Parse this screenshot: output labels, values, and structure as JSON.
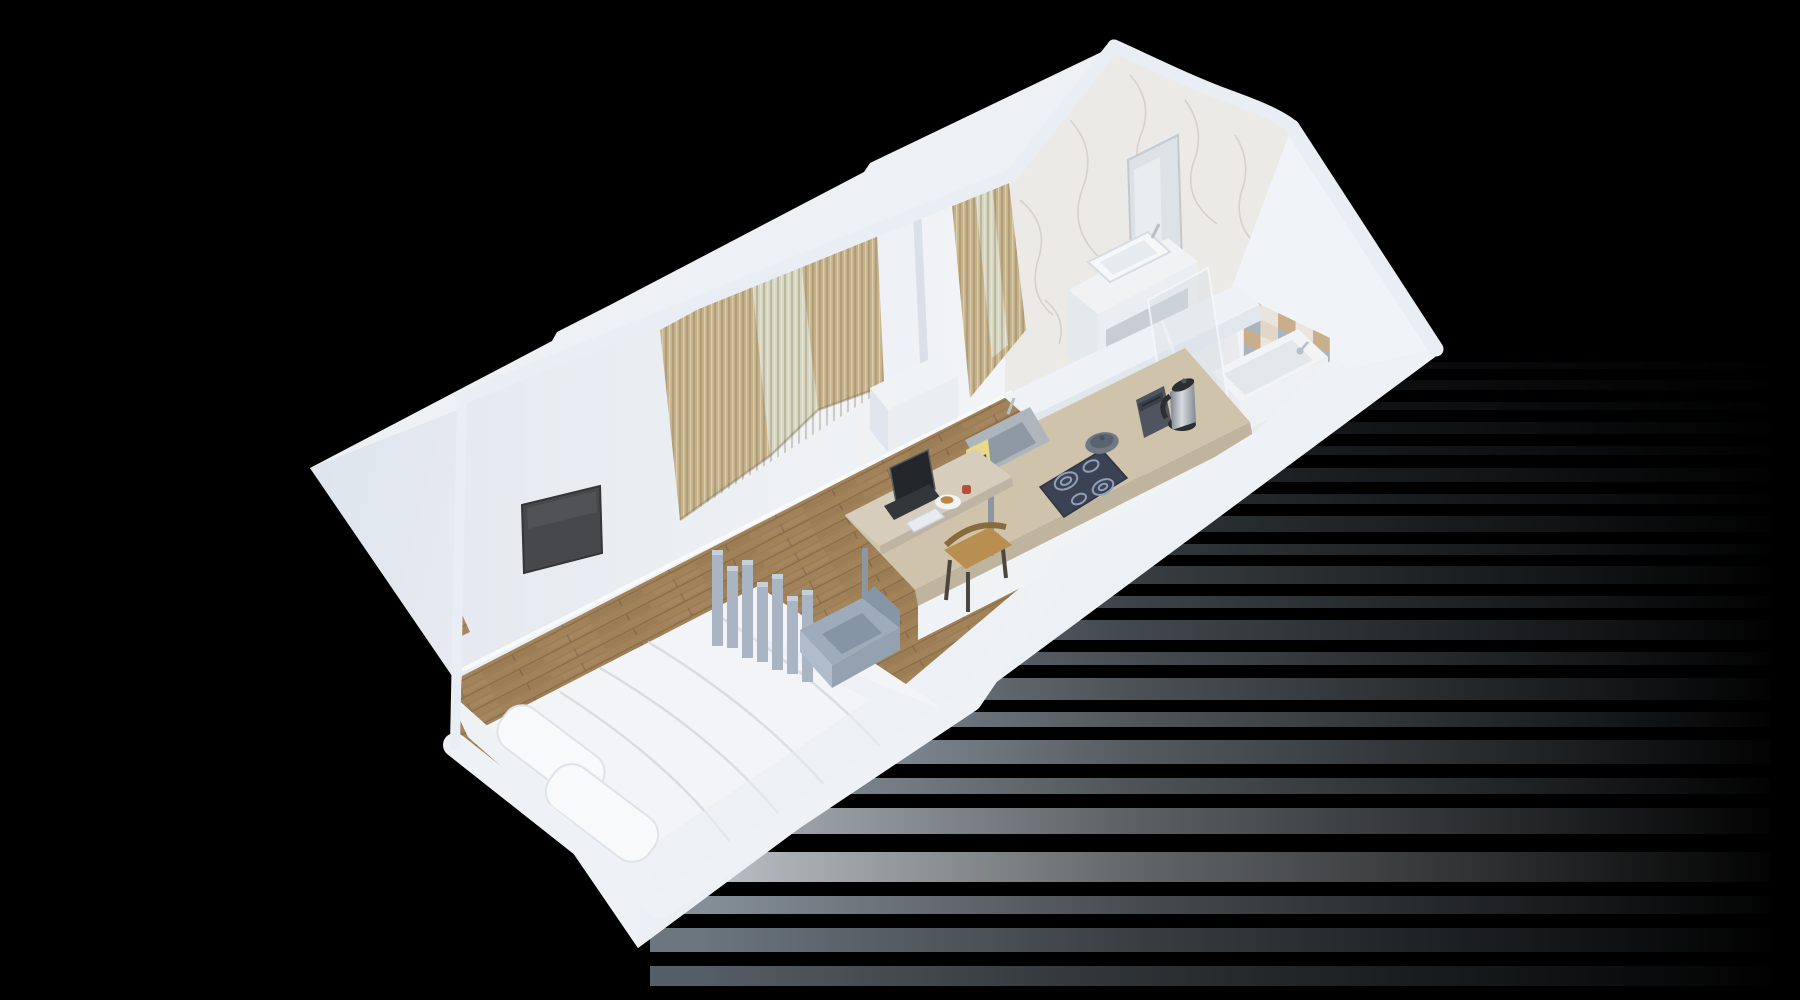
{
  "scene": {
    "kind": "isometric-3d-floorplan-render",
    "background": "#000000",
    "rooms": [
      "bedroom-living",
      "kitchen",
      "bathroom"
    ]
  },
  "palette": {
    "bg": "#000000",
    "shell": "#edf0f4",
    "shellLeft": "#e1e7ee",
    "shellFront": "#f1f4f8",
    "cutTop": "#e9eef5",
    "cutTopFront": "#eef2f7",
    "wallInner": "#e9edf2",
    "wallInnerLight": "#f0f3f7",
    "wood": "#ab8b60",
    "woodDark": "#8f7350",
    "bathFloor": "#e8eaed",
    "marble": "#eceae7",
    "marbleVein": "#c9c3bd",
    "curtain": "#c6b28a",
    "curtainSheer": "#d6d6c2",
    "pillar": "#eef1f5",
    "tv": "#47484c",
    "bedding": "#f2f4f7",
    "pillow": "#f7f9fb",
    "headboard": "#eff2f5",
    "divider": "#a9b5c3",
    "dividerTop": "#c6d0da",
    "armchair": "#9dabbb",
    "armchairSeat": "#8695a6",
    "counter": "#cfc3ab",
    "counterEdge": "#bfb49d",
    "deskTop": "#d6cdbd",
    "deskLeg": "#8d97a1",
    "chairWood": "#b98e51",
    "chairFrame": "#4b463f",
    "laptop": "#33373c",
    "laptopScreen": "#23262b",
    "plate": "#f3f4f5",
    "croissant": "#c08445",
    "redCup": "#b5503a",
    "coffeeMachine": "#e8d98a",
    "sinkSteel": "#aeb6bd",
    "sinkBasin": "#8f99a3",
    "cooktop": "#3b4254",
    "cooktopRing": "#8fa0b8",
    "pan": "#6f7a85",
    "toaster": "#4e555e",
    "kettleDark": "#2b2e33",
    "vanity": "#f0f2f4",
    "vanityShade": "#e4e9ee",
    "vanityRecess": "#c8cdd3",
    "vesselSink": "#f5f7f9",
    "mirror": "#dde2e6",
    "tub": "#f1f3f5",
    "tubInner": "#e2e7eb",
    "halfWall": "#eef1f5",
    "glass": "#d2dce4",
    "tileTan": "#c9ae8b",
    "tileCream": "#e9e4dc",
    "tileGray": "#aab4bd",
    "chrome": "#b8bfc6",
    "skirting": "#f8fafb",
    "glassDoor": "#cfd8df"
  },
  "objects": {
    "bedroom": [
      "bed",
      "pillows",
      "headboard",
      "slat-divider",
      "armchair",
      "wall-tv",
      "entry-glass-door"
    ],
    "living": [
      "curtain-window-left",
      "curtain-window-right",
      "column",
      "desk",
      "laptop",
      "notebook",
      "plate",
      "red-cup",
      "wood-chair"
    ],
    "kitchen": [
      "counter",
      "inset-sink",
      "coffee-machine",
      "cooktop",
      "pan",
      "toaster",
      "kettle"
    ],
    "bathroom": [
      "marble-wall",
      "mirror",
      "vanity",
      "vessel-sink",
      "shower-glass",
      "bathtub",
      "tub-faucet",
      "checker-accent-wall",
      "half-wall"
    ]
  }
}
